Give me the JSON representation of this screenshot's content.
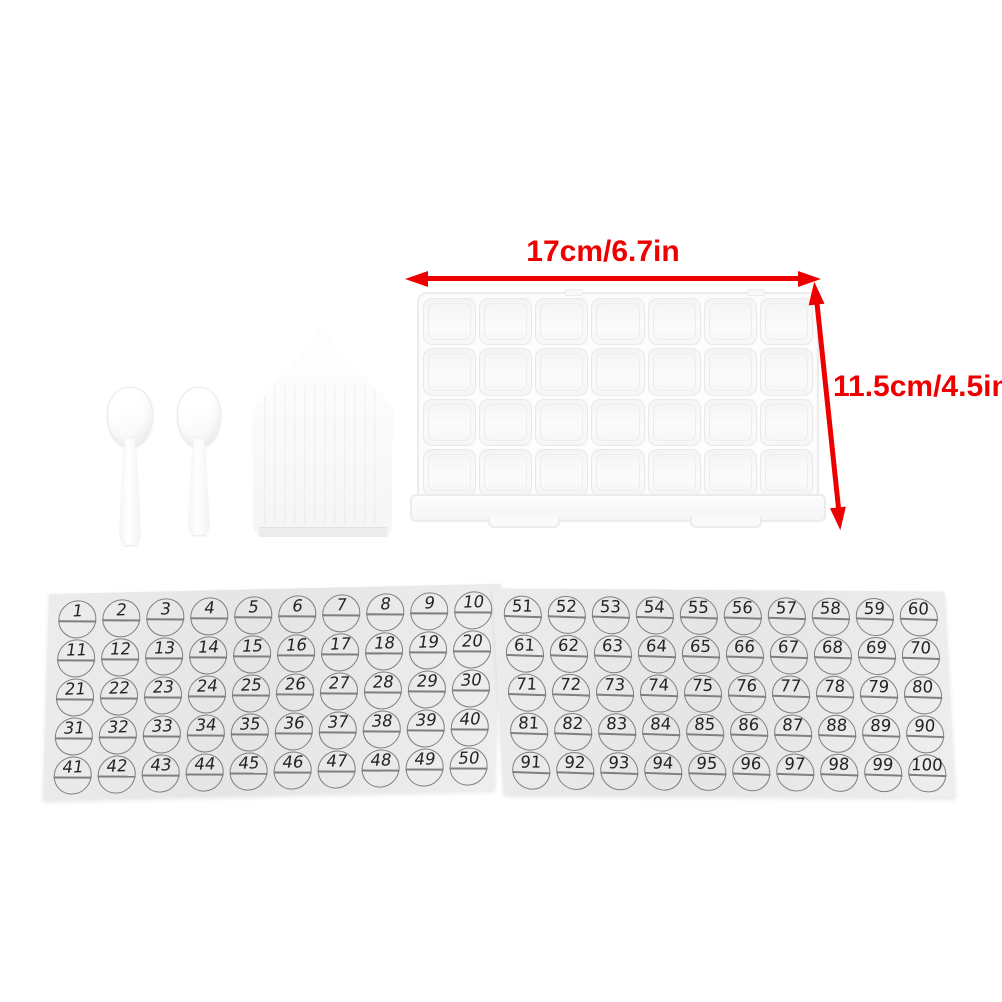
{
  "photo": {
    "background_color": "#ffffff",
    "accent_color": "#ee0000",
    "sheet_color": "#e8e8e8"
  },
  "annotations": {
    "width_label": "17cm/6.7in",
    "height_label": "11.5cm/4.5in"
  },
  "items": {
    "box": {
      "rows": 4,
      "columns": 7,
      "cell_total": 28
    }
  },
  "sticker_sheets": [
    {
      "id": "sheet-1-50",
      "numbers": [
        1,
        2,
        3,
        4,
        5,
        6,
        7,
        8,
        9,
        10,
        11,
        12,
        13,
        14,
        15,
        16,
        17,
        18,
        19,
        20,
        21,
        22,
        23,
        24,
        25,
        26,
        27,
        28,
        29,
        30,
        31,
        32,
        33,
        34,
        35,
        36,
        37,
        38,
        39,
        40,
        41,
        42,
        43,
        44,
        45,
        46,
        47,
        48,
        49,
        50
      ]
    },
    {
      "id": "sheet-51-100",
      "numbers": [
        51,
        52,
        53,
        54,
        55,
        56,
        57,
        58,
        59,
        60,
        61,
        62,
        63,
        64,
        65,
        66,
        67,
        68,
        69,
        70,
        71,
        72,
        73,
        74,
        75,
        76,
        77,
        78,
        79,
        80,
        81,
        82,
        83,
        84,
        85,
        86,
        87,
        88,
        89,
        90,
        91,
        92,
        93,
        94,
        95,
        96,
        97,
        98,
        99,
        100
      ]
    }
  ]
}
